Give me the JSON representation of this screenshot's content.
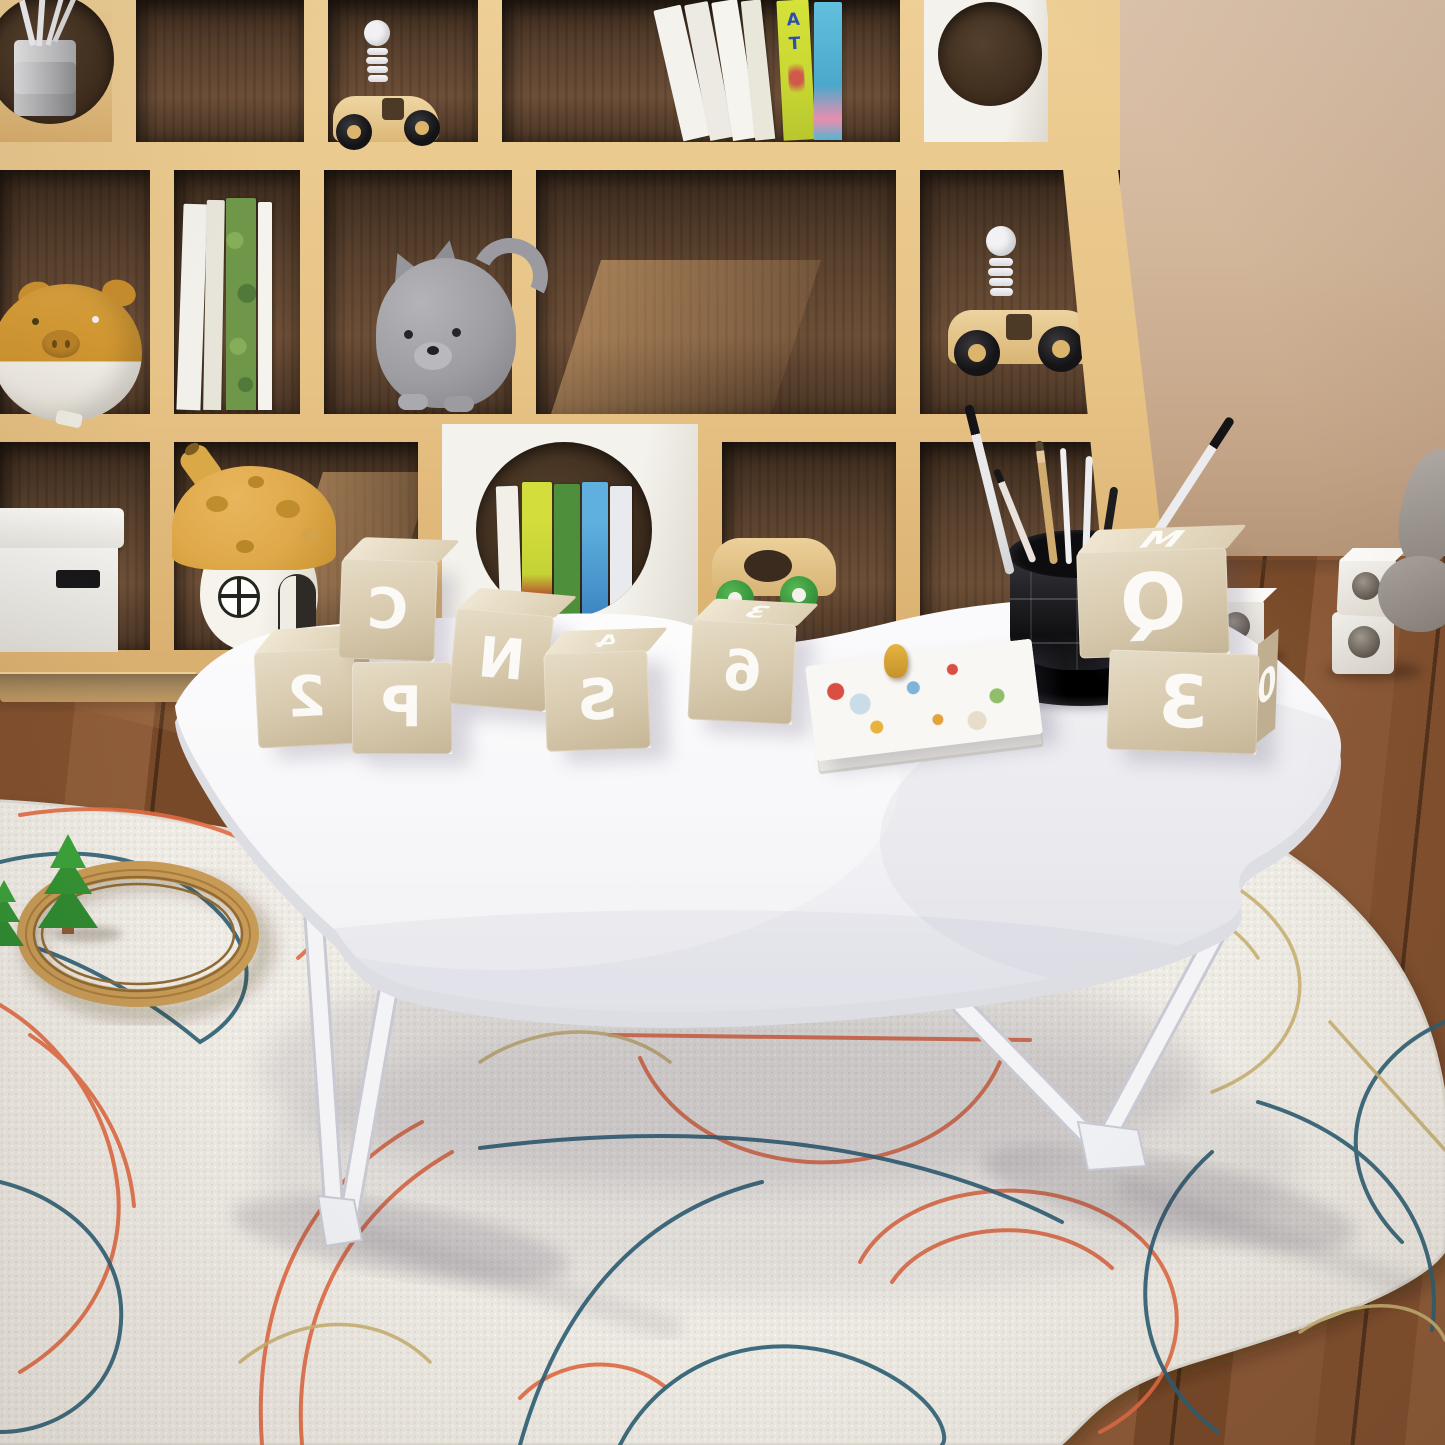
{
  "scene": {
    "description": "Sunlit children's playroom product photo: white cloud-shaped folding lap table with built-in black cup holder standing on an abstract line-pattern rug; wooden cubby bookshelf with toys behind; walnut wood floor; warm daylight from the left",
    "product": "white foldable bed/floor tray table"
  },
  "palette": {
    "wall": "#d2b79c",
    "floor": "#81502e",
    "shelf_wood": "#e7c386",
    "cubby_interior": "#4c3625",
    "rug": "#eeebe4",
    "rug_coral": "#e06a43",
    "rug_teal": "#2b5f74",
    "rug_khaki": "#c8b172",
    "table_white": "#f4f4f7",
    "cup_black": "#1b1b1e",
    "block_wood": "#d8cbb2",
    "block_letter": "#ffffff",
    "mushroom_cap": "#dfaa4c",
    "piggy_amber": "#d59a36",
    "cat_gray": "#9d9da2",
    "tree_green": "#3aa23a",
    "track_wood": "#c79a56"
  },
  "table_blocks": [
    {
      "front": "2",
      "top": "",
      "side": "3"
    },
    {
      "front": "C",
      "top": "",
      "side": ""
    },
    {
      "front": "P",
      "top": "",
      "side": ""
    },
    {
      "front": "N",
      "top": "",
      "side": ""
    },
    {
      "front": "S",
      "top": "4",
      "side": ""
    },
    {
      "front": "6",
      "top": "3",
      "side": ""
    },
    {
      "front": "Q",
      "top": "M",
      "side": ""
    },
    {
      "front": "3",
      "top": "",
      "side": "0"
    }
  ],
  "alphabet_book_spine": {
    "letters": [
      "A",
      "T"
    ]
  },
  "objects": {
    "on_table": [
      "wooden letter blocks",
      "picture book",
      "yellow game piece",
      "black cup holder with paint brushes and pencils"
    ],
    "in_shelf": [
      "pencil cup behind round cut-out",
      "wooden race car with spring driver",
      "leaning picture books",
      "white round-hole panel",
      "amber piggy bank",
      "books",
      "gray cat coin bank",
      "second wooden race car",
      "white storage box",
      "mushroom house lamp",
      "round window with books",
      "wooden car with green wheels"
    ],
    "on_floor": [
      "white hole cubes",
      "gray plush toy"
    ],
    "on_rug": [
      "wooden train track ring",
      "green cone trees"
    ]
  }
}
